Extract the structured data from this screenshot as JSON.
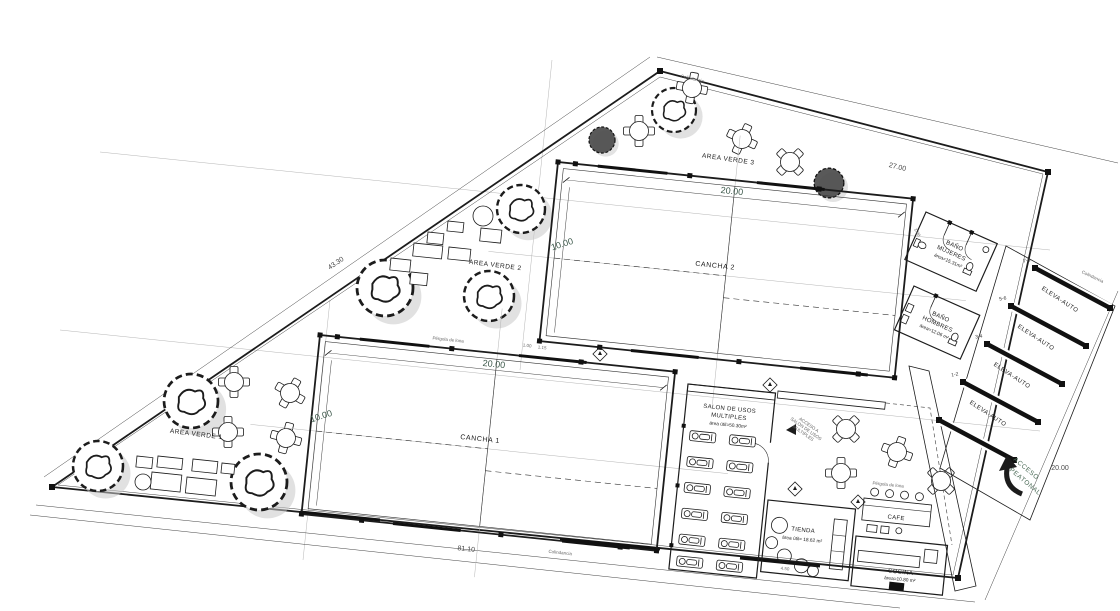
{
  "labels": {
    "verde1": "AREA VERDE 1",
    "verde2": "AREA VERDE 2",
    "verde3": "AREA VERDE 3",
    "cancha1": "CANCHA 1",
    "cancha2": "CANCHA 2",
    "salon1": "SALON DE USOS",
    "salon2": "MULTIPLES",
    "salon_area": "área útil=50.30m²",
    "banom1": "BAÑO",
    "banom2": "MUJERES",
    "banom_area": "área=15.31m²",
    "banoh1": "BAÑO",
    "banoh2": "HOMBRES",
    "banoh_area": "área=12.06 m²",
    "tienda": "TIENDA",
    "tienda_area": "área útil= 18.62 m²",
    "cafe": "CAFE",
    "cocina": "COCINA",
    "cocina_area": "área=10.80 m²",
    "acceso1": "ACCESO",
    "acceso2": "PEATONAL"
  },
  "parking": {
    "label": "ELEVA-AUTO",
    "stalls": [
      "7-8",
      "5-6",
      "3-4",
      "1-2"
    ]
  },
  "dims": {
    "c_w": "20.00",
    "c_h": "10.00",
    "tr": "27.00",
    "tl": "43.30",
    "b": "81.10",
    "r": "20.00",
    "o1": "1.00",
    "o2": "1.15",
    "o3": "1.00",
    "t1": "4.50"
  },
  "notes": {
    "colind": "Colindancia",
    "pergola": "Pérgola de lona",
    "as1": "ACCESO A",
    "as2": "SALON DE USOS",
    "as3": "MULTIPLES"
  }
}
